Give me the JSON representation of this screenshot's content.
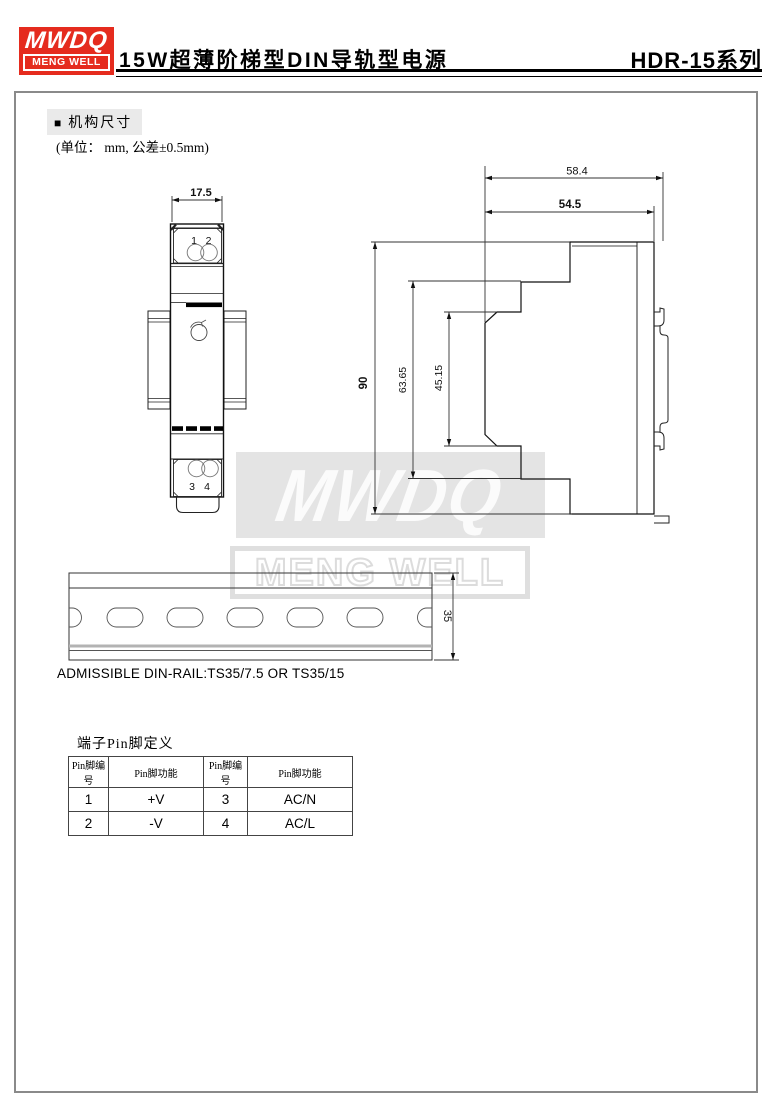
{
  "header": {
    "logo_line1": "MWDQ",
    "logo_line2": "MENG WELL",
    "title": "15W超薄阶梯型DIN导轨型电源",
    "series": "HDR-15系列",
    "brand_red": "#e52b1e"
  },
  "section": {
    "bullet": "■",
    "heading": "机构尺寸",
    "unit_note": "(单位： mm, 公差±0.5mm)",
    "highlight_gray": "#eaeaea"
  },
  "front_view": {
    "width_dim": "17.5",
    "pins": [
      "1",
      "2",
      "3",
      "4"
    ]
  },
  "side_view": {
    "depth_with_clip": "58.4",
    "depth_body": "54.5",
    "height_total": "90",
    "height_step1": "63.65",
    "height_step2": "45.15"
  },
  "din_rail": {
    "height_dim": "35",
    "note": "ADMISSIBLE DIN-RAIL:TS35/7.5 OR TS35/15"
  },
  "watermark": {
    "line1": "MWDQ",
    "line2": "MENG WELL",
    "gray": "#e4e4e4"
  },
  "pin_table": {
    "title": "端子Pin脚定义",
    "headers": [
      "Pin脚编号",
      "Pin脚功能",
      "Pin脚编号",
      "Pin脚功能"
    ],
    "rows": [
      [
        "1",
        "+V",
        "3",
        "AC/N"
      ],
      [
        "2",
        "-V",
        "4",
        "AC/L"
      ]
    ]
  }
}
